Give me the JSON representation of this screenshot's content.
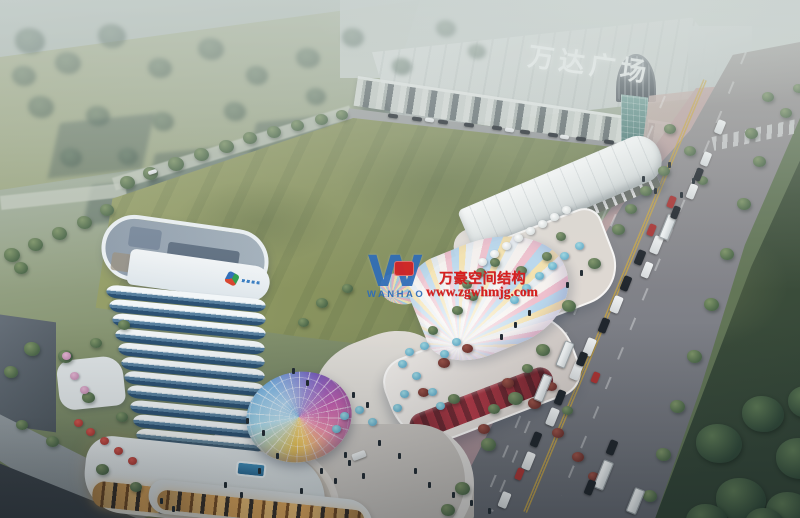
{
  "meta": {
    "description": "Aerial dusk rendering of a mixed-use commercial plaza beside Wanda Plaza, with curved hotel tower, iridescent glass canopies and arterial road",
    "image_type": "architectural-rendering"
  },
  "signage": {
    "mall_sign": "万达广场"
  },
  "watermark": {
    "logo_mark": "W",
    "logo_text": "WANHAO",
    "line1": "万豪空间结构",
    "line2": "www.zgwhmjg.com"
  },
  "palette": {
    "wm_red": "#d81e1e",
    "logo_blue": "#2f6db8",
    "sign_white": "#f4f8f7",
    "lawn_green": "#8a945f",
    "dark_lawn": "#324437",
    "road_gray": "#8f8d90",
    "sidewalk_pink": "#b49a9e",
    "tower_white": "#eef3f6",
    "tower_glass": "#2c5173",
    "warm_light": "#e0a75c"
  },
  "scene": {
    "tower": {
      "floor_count": 13
    },
    "trees": [
      [
        15,
        28,
        30,
        "h"
      ],
      [
        55,
        52,
        26,
        "h"
      ],
      [
        98,
        24,
        28,
        "h"
      ],
      [
        148,
        58,
        24,
        "h"
      ],
      [
        198,
        38,
        26,
        "h"
      ],
      [
        246,
        66,
        22,
        "h"
      ],
      [
        296,
        48,
        24,
        "h"
      ],
      [
        28,
        96,
        26,
        "h"
      ],
      [
        86,
        106,
        24,
        "h"
      ],
      [
        152,
        112,
        22,
        "h"
      ],
      [
        224,
        102,
        22,
        "h"
      ],
      [
        342,
        28,
        22,
        "h"
      ],
      [
        392,
        58,
        20,
        "h"
      ],
      [
        306,
        88,
        20,
        "h"
      ],
      [
        12,
        66,
        24,
        "h"
      ],
      [
        60,
        148,
        22,
        "h"
      ],
      [
        118,
        148,
        20,
        "h"
      ],
      [
        436,
        20,
        20,
        "h"
      ],
      [
        468,
        44,
        18,
        "h"
      ],
      [
        120,
        176,
        15,
        "g"
      ],
      [
        143,
        167,
        15,
        "g"
      ],
      [
        168,
        157,
        16,
        "g"
      ],
      [
        194,
        148,
        15,
        "g"
      ],
      [
        219,
        140,
        15,
        "g"
      ],
      [
        243,
        132,
        14,
        "g"
      ],
      [
        267,
        126,
        14,
        "g"
      ],
      [
        291,
        120,
        13,
        "g"
      ],
      [
        315,
        114,
        13,
        "g"
      ],
      [
        336,
        110,
        12,
        "g"
      ],
      [
        4,
        248,
        16,
        "g"
      ],
      [
        28,
        238,
        15,
        "g"
      ],
      [
        52,
        227,
        15,
        "g"
      ],
      [
        77,
        216,
        15,
        "g"
      ],
      [
        100,
        204,
        14,
        "g"
      ],
      [
        14,
        262,
        14,
        "g"
      ],
      [
        24,
        342,
        16,
        "g"
      ],
      [
        58,
        350,
        15,
        "g"
      ],
      [
        4,
        366,
        14,
        "g"
      ],
      [
        90,
        338,
        12,
        "g"
      ],
      [
        118,
        320,
        12,
        "g"
      ],
      [
        46,
        436,
        13,
        "g"
      ],
      [
        96,
        464,
        13,
        "g"
      ],
      [
        16,
        420,
        12,
        "g"
      ],
      [
        130,
        482,
        12,
        "g"
      ],
      [
        664,
        124,
        12,
        "g"
      ],
      [
        684,
        146,
        12,
        "g"
      ],
      [
        658,
        166,
        12,
        "g"
      ],
      [
        640,
        186,
        12,
        "g"
      ],
      [
        697,
        176,
        11,
        "g"
      ],
      [
        625,
        204,
        12,
        "g"
      ],
      [
        612,
        224,
        13,
        "g"
      ],
      [
        588,
        258,
        13,
        "g"
      ],
      [
        562,
        300,
        14,
        "g"
      ],
      [
        536,
        344,
        14,
        "g"
      ],
      [
        508,
        392,
        15,
        "g"
      ],
      [
        481,
        438,
        15,
        "g"
      ],
      [
        455,
        482,
        15,
        "g"
      ],
      [
        441,
        504,
        14,
        "g"
      ],
      [
        745,
        128,
        13,
        "g"
      ],
      [
        753,
        156,
        13,
        "g"
      ],
      [
        737,
        198,
        14,
        "g"
      ],
      [
        720,
        248,
        14,
        "g"
      ],
      [
        704,
        298,
        15,
        "g"
      ],
      [
        687,
        350,
        15,
        "g"
      ],
      [
        670,
        400,
        15,
        "g"
      ],
      [
        656,
        448,
        15,
        "g"
      ],
      [
        643,
        490,
        14,
        "g"
      ],
      [
        696,
        424,
        46,
        "d"
      ],
      [
        742,
        396,
        42,
        "d"
      ],
      [
        776,
        438,
        48,
        "d"
      ],
      [
        716,
        478,
        50,
        "d"
      ],
      [
        766,
        492,
        46,
        "d"
      ],
      [
        788,
        386,
        38,
        "d"
      ],
      [
        686,
        504,
        42,
        "d"
      ],
      [
        745,
        508,
        40,
        "d"
      ],
      [
        762,
        92,
        12,
        "g"
      ],
      [
        780,
        108,
        12,
        "g"
      ],
      [
        793,
        84,
        11,
        "g"
      ],
      [
        516,
        266,
        11,
        "g"
      ],
      [
        542,
        252,
        10,
        "g"
      ],
      [
        556,
        232,
        10,
        "g"
      ],
      [
        452,
        306,
        11,
        "g"
      ],
      [
        428,
        326,
        10,
        "g"
      ],
      [
        468,
        292,
        10,
        "g"
      ],
      [
        438,
        358,
        12,
        "r"
      ],
      [
        462,
        344,
        11,
        "r"
      ],
      [
        502,
        378,
        12,
        "r"
      ],
      [
        528,
        398,
        13,
        "r"
      ],
      [
        478,
        424,
        12,
        "r"
      ],
      [
        552,
        428,
        12,
        "r"
      ],
      [
        418,
        388,
        11,
        "r"
      ],
      [
        572,
        452,
        12,
        "r"
      ],
      [
        588,
        472,
        11,
        "r"
      ],
      [
        546,
        382,
        11,
        "r"
      ],
      [
        448,
        394,
        12,
        "g"
      ],
      [
        488,
        404,
        12,
        "g"
      ],
      [
        522,
        364,
        11,
        "g"
      ],
      [
        562,
        406,
        11,
        "g"
      ],
      [
        316,
        298,
        12,
        "g"
      ],
      [
        342,
        284,
        11,
        "g"
      ],
      [
        298,
        318,
        11,
        "g"
      ],
      [
        82,
        392,
        13,
        "g"
      ],
      [
        116,
        412,
        12,
        "g"
      ],
      [
        476,
        268,
        10,
        "g"
      ],
      [
        490,
        258,
        10,
        "g"
      ],
      [
        462,
        280,
        10,
        "g"
      ]
    ],
    "vehicles": [
      [
        652,
        236,
        9,
        18,
        "w",
        22
      ],
      [
        643,
        262,
        8,
        16,
        "w",
        22
      ],
      [
        612,
        296,
        9,
        17,
        "w",
        22
      ],
      [
        585,
        338,
        9,
        18,
        "w",
        22
      ],
      [
        702,
        152,
        8,
        14,
        "w",
        22
      ],
      [
        716,
        120,
        8,
        14,
        "w",
        22
      ],
      [
        688,
        184,
        8,
        15,
        "w",
        22
      ],
      [
        572,
        362,
        9,
        18,
        "w",
        22
      ],
      [
        548,
        408,
        9,
        18,
        "w",
        22
      ],
      [
        524,
        452,
        9,
        18,
        "w",
        22
      ],
      [
        500,
        492,
        9,
        16,
        "w",
        22
      ],
      [
        663,
        214,
        10,
        26,
        "b",
        22
      ],
      [
        560,
        341,
        10,
        27,
        "b",
        22
      ],
      [
        538,
        374,
        10,
        28,
        "b",
        22
      ],
      [
        598,
        460,
        11,
        30,
        "b",
        22
      ],
      [
        630,
        488,
        11,
        26,
        "b",
        22
      ],
      [
        636,
        250,
        8,
        15,
        "d",
        22
      ],
      [
        622,
        276,
        8,
        15,
        "d",
        22
      ],
      [
        600,
        318,
        8,
        15,
        "d",
        22
      ],
      [
        578,
        352,
        8,
        14,
        "d",
        22
      ],
      [
        556,
        390,
        8,
        15,
        "d",
        22
      ],
      [
        532,
        432,
        8,
        15,
        "d",
        22
      ],
      [
        672,
        206,
        7,
        13,
        "d",
        22
      ],
      [
        695,
        168,
        7,
        13,
        "d",
        22
      ],
      [
        608,
        440,
        8,
        15,
        "d",
        22
      ],
      [
        586,
        480,
        8,
        15,
        "d",
        22
      ],
      [
        668,
        196,
        7,
        12,
        "r",
        22
      ],
      [
        648,
        224,
        7,
        12,
        "r",
        22
      ],
      [
        516,
        468,
        7,
        12,
        "r",
        22
      ],
      [
        592,
        372,
        7,
        11,
        "r",
        22
      ],
      [
        388,
        114,
        10,
        4,
        "d",
        8
      ],
      [
        412,
        117,
        10,
        4,
        "d",
        8
      ],
      [
        438,
        120,
        10,
        4,
        "d",
        8
      ],
      [
        464,
        123,
        10,
        4,
        "d",
        8
      ],
      [
        492,
        126,
        10,
        4,
        "d",
        8
      ],
      [
        520,
        130,
        10,
        4,
        "d",
        8
      ],
      [
        548,
        133,
        10,
        4,
        "d",
        8
      ],
      [
        576,
        137,
        10,
        4,
        "d",
        8
      ],
      [
        604,
        140,
        10,
        4,
        "d",
        8
      ],
      [
        425,
        118,
        9,
        4,
        "w",
        8
      ],
      [
        505,
        128,
        9,
        4,
        "w",
        8
      ],
      [
        560,
        135,
        9,
        4,
        "w",
        8
      ],
      [
        148,
        170,
        9,
        4,
        "w",
        -17
      ],
      [
        352,
        452,
        14,
        7,
        "w",
        -21
      ]
    ],
    "umbrellas": [
      [
        548,
        262,
        "b"
      ],
      [
        560,
        252,
        "b"
      ],
      [
        535,
        272,
        "b"
      ],
      [
        522,
        284,
        "b"
      ],
      [
        575,
        242,
        "b"
      ],
      [
        510,
        296,
        "b"
      ],
      [
        405,
        348,
        "b"
      ],
      [
        420,
        342,
        "b"
      ],
      [
        398,
        360,
        "b"
      ],
      [
        412,
        372,
        "b"
      ],
      [
        428,
        388,
        "b"
      ],
      [
        400,
        390,
        "b"
      ],
      [
        440,
        350,
        "b"
      ],
      [
        436,
        402,
        "b"
      ],
      [
        393,
        404,
        "b"
      ],
      [
        452,
        338,
        "b"
      ],
      [
        340,
        412,
        "b"
      ],
      [
        355,
        406,
        "b"
      ],
      [
        368,
        418,
        "b"
      ],
      [
        332,
        425,
        "b"
      ],
      [
        502,
        242,
        "w"
      ],
      [
        514,
        234,
        "w"
      ],
      [
        526,
        227,
        "w"
      ],
      [
        538,
        220,
        "w"
      ],
      [
        490,
        250,
        "w"
      ],
      [
        478,
        258,
        "w"
      ],
      [
        550,
        213,
        "w"
      ],
      [
        562,
        206,
        "w"
      ],
      [
        86,
        428,
        "r"
      ],
      [
        100,
        437,
        "r"
      ],
      [
        114,
        447,
        "r"
      ],
      [
        74,
        419,
        "r"
      ],
      [
        128,
        457,
        "r"
      ],
      [
        70,
        372,
        "p"
      ],
      [
        80,
        386,
        "p"
      ],
      [
        62,
        352,
        "p"
      ]
    ],
    "people": [
      [
        320,
        468
      ],
      [
        334,
        478
      ],
      [
        348,
        460
      ],
      [
        362,
        473
      ],
      [
        300,
        488
      ],
      [
        378,
        440
      ],
      [
        398,
        453
      ],
      [
        414,
        468
      ],
      [
        428,
        482
      ],
      [
        276,
        453
      ],
      [
        258,
        468
      ],
      [
        160,
        498
      ],
      [
        172,
        506
      ],
      [
        642,
        176
      ],
      [
        654,
        188
      ],
      [
        668,
        162
      ],
      [
        680,
        192
      ],
      [
        692,
        178
      ],
      [
        246,
        418
      ],
      [
        262,
        430
      ],
      [
        352,
        392
      ],
      [
        366,
        402
      ],
      [
        306,
        380
      ],
      [
        292,
        368
      ],
      [
        528,
        310
      ],
      [
        514,
        322
      ],
      [
        500,
        334
      ],
      [
        566,
        282
      ],
      [
        580,
        270
      ],
      [
        344,
        452
      ],
      [
        240,
        492
      ],
      [
        224,
        482
      ],
      [
        470,
        500
      ],
      [
        488,
        508
      ],
      [
        452,
        492
      ]
    ],
    "blur_buildings": [
      [
        55,
        118,
        92,
        56
      ],
      [
        150,
        148,
        102,
        60
      ],
      [
        252,
        118,
        82,
        50
      ],
      [
        330,
        148,
        70,
        44
      ],
      [
        88,
        182,
        72,
        40
      ],
      [
        200,
        188,
        92,
        44
      ],
      [
        360,
        100,
        60,
        38
      ]
    ],
    "rural_roads": [
      [
        0,
        196,
        126,
        14,
        -6
      ],
      [
        112,
        178,
        248,
        13,
        -17
      ]
    ]
  }
}
